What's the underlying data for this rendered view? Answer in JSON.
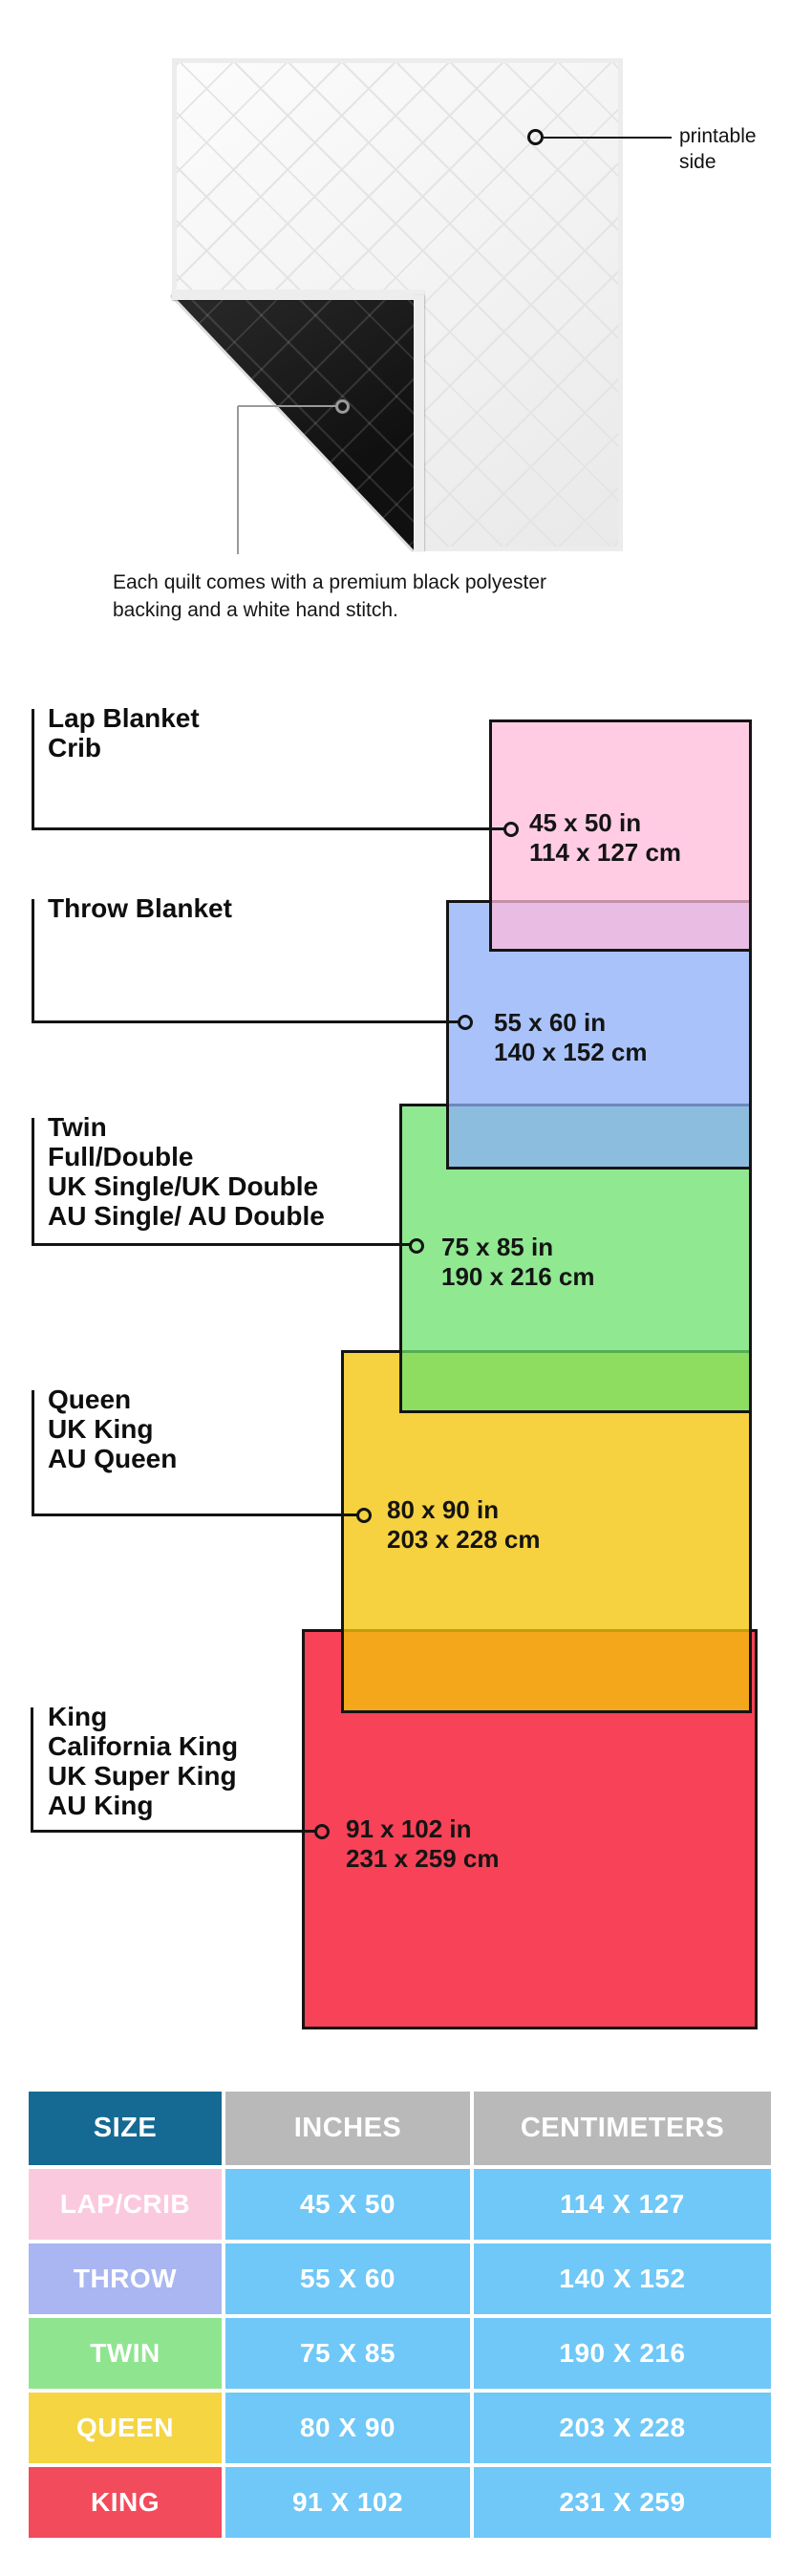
{
  "hero": {
    "printable_label": "printable\nside",
    "caption": "Each quilt comes with a premium black polyester\nbacking and a white hand stitch.",
    "quilt_front_color": "#f6f6f6",
    "quilt_back_color": "#161616"
  },
  "diagram": {
    "items": [
      {
        "label": "Lap Blanket\nCrib",
        "inches": "45 x 50 in",
        "cm": "114 x 127 cm",
        "fill": "rgba(255,187,219,0.75)",
        "solid": "#FFCCE4"
      },
      {
        "label": "Throw Blanket",
        "inches": "55 x 60 in",
        "cm": "140 x 152 cm",
        "fill": "rgba(140,175,248,0.75)",
        "solid": "#A9C3FA"
      },
      {
        "label": "Twin\nFull/Double\nUK Single/UK Double\nAU Single/ AU Double",
        "inches": "75 x 85 in",
        "cm": "190 x 216 cm",
        "fill": "rgba(107,224,107,0.75)",
        "solid": "#90E690"
      },
      {
        "label": "Queen\nUK King\nAU Queen",
        "inches": "80 x 90 in",
        "cm": "203 x 228 cm",
        "fill": "rgba(243,196,10,0.78)",
        "solid": "#F5D140"
      },
      {
        "label": "King\nCalifornia King\nUK Super King\nAU King",
        "inches": "91 x 102 in",
        "cm": "231 x 259 cm",
        "fill": "rgba(246,30,55,0.84)",
        "solid": "#F8485E"
      }
    ],
    "border_color": "#141414"
  },
  "table": {
    "headers": [
      "SIZE",
      "INCHES",
      "CENTIMETERS"
    ],
    "rows": [
      {
        "size": "LAP/CRIB",
        "inches": "45 X 50",
        "cm": "114 X 127",
        "color": "#FBC9DD"
      },
      {
        "size": "THROW",
        "inches": "55 X 60",
        "cm": "140 X 152",
        "color": "#A9B6F2"
      },
      {
        "size": "TWIN",
        "inches": "75 X 85",
        "cm": "190 X 216",
        "color": "#8FE58F"
      },
      {
        "size": "QUEEN",
        "inches": "80 X 90",
        "cm": "203 X 228",
        "color": "#F5D541"
      },
      {
        "size": "KING",
        "inches": "91 X 102",
        "cm": "231 X 259",
        "color": "#F24B5C"
      }
    ],
    "colors": {
      "header_size_bg": "#156A93",
      "header_bg": "#B9B9B9",
      "data_bg": "#6FC8F7",
      "text": "#FFFFFF"
    }
  }
}
